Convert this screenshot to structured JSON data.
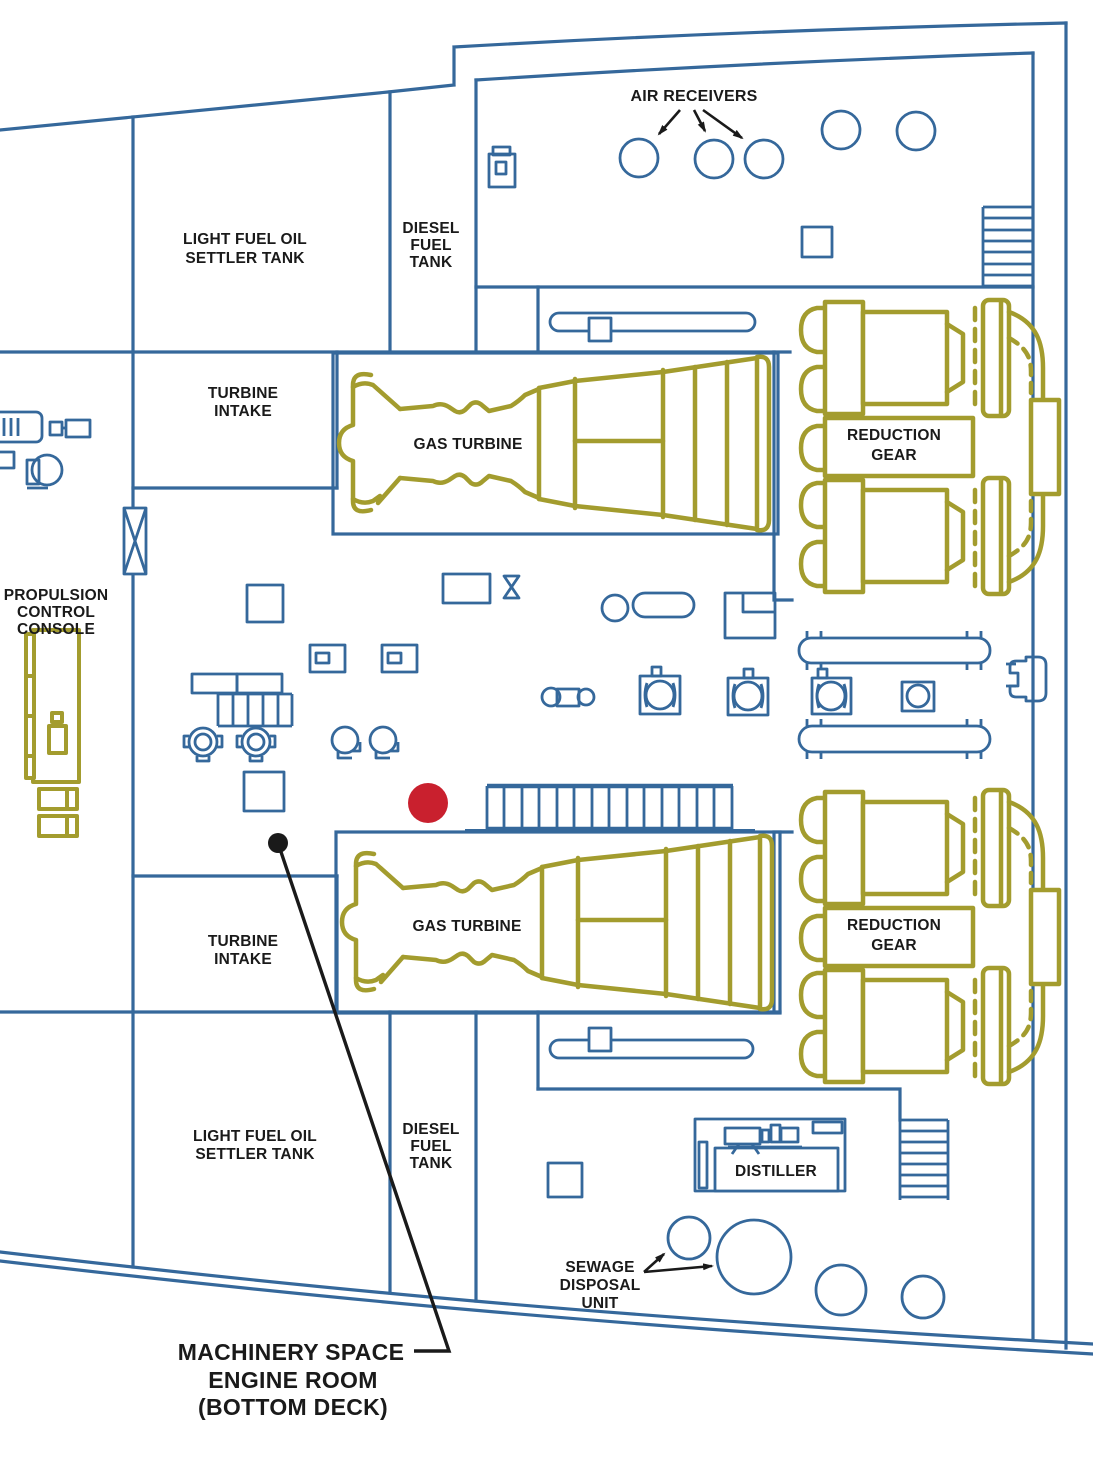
{
  "caption": [
    "MACHINERY SPACE",
    "ENGINE ROOM",
    "(BOTTOM DECK)"
  ],
  "labels": {
    "air_receivers": "AIR RECEIVERS",
    "light_fuel_oil": [
      "LIGHT FUEL OIL",
      "SETTLER TANK"
    ],
    "diesel_fuel_tank": [
      "DIESEL",
      "FUEL",
      "TANK"
    ],
    "turbine_intake": [
      "TURBINE",
      "INTAKE"
    ],
    "gas_turbine": "GAS TURBINE",
    "reduction_gear": [
      "REDUCTION",
      "GEAR"
    ],
    "propulsion_console": [
      "PROPULSION",
      "CONTROL",
      "CONSOLE"
    ],
    "distiller": "DISTILLER",
    "sewage_disposal": [
      "SEWAGE",
      "DISPOSAL",
      "UNIT"
    ]
  },
  "colors": {
    "structure_blue": "#35689b",
    "machinery_olive": "#a39c2e",
    "marker_red": "#c9202e",
    "annotation_black": "#1a1a1a",
    "background": "#ffffff"
  }
}
